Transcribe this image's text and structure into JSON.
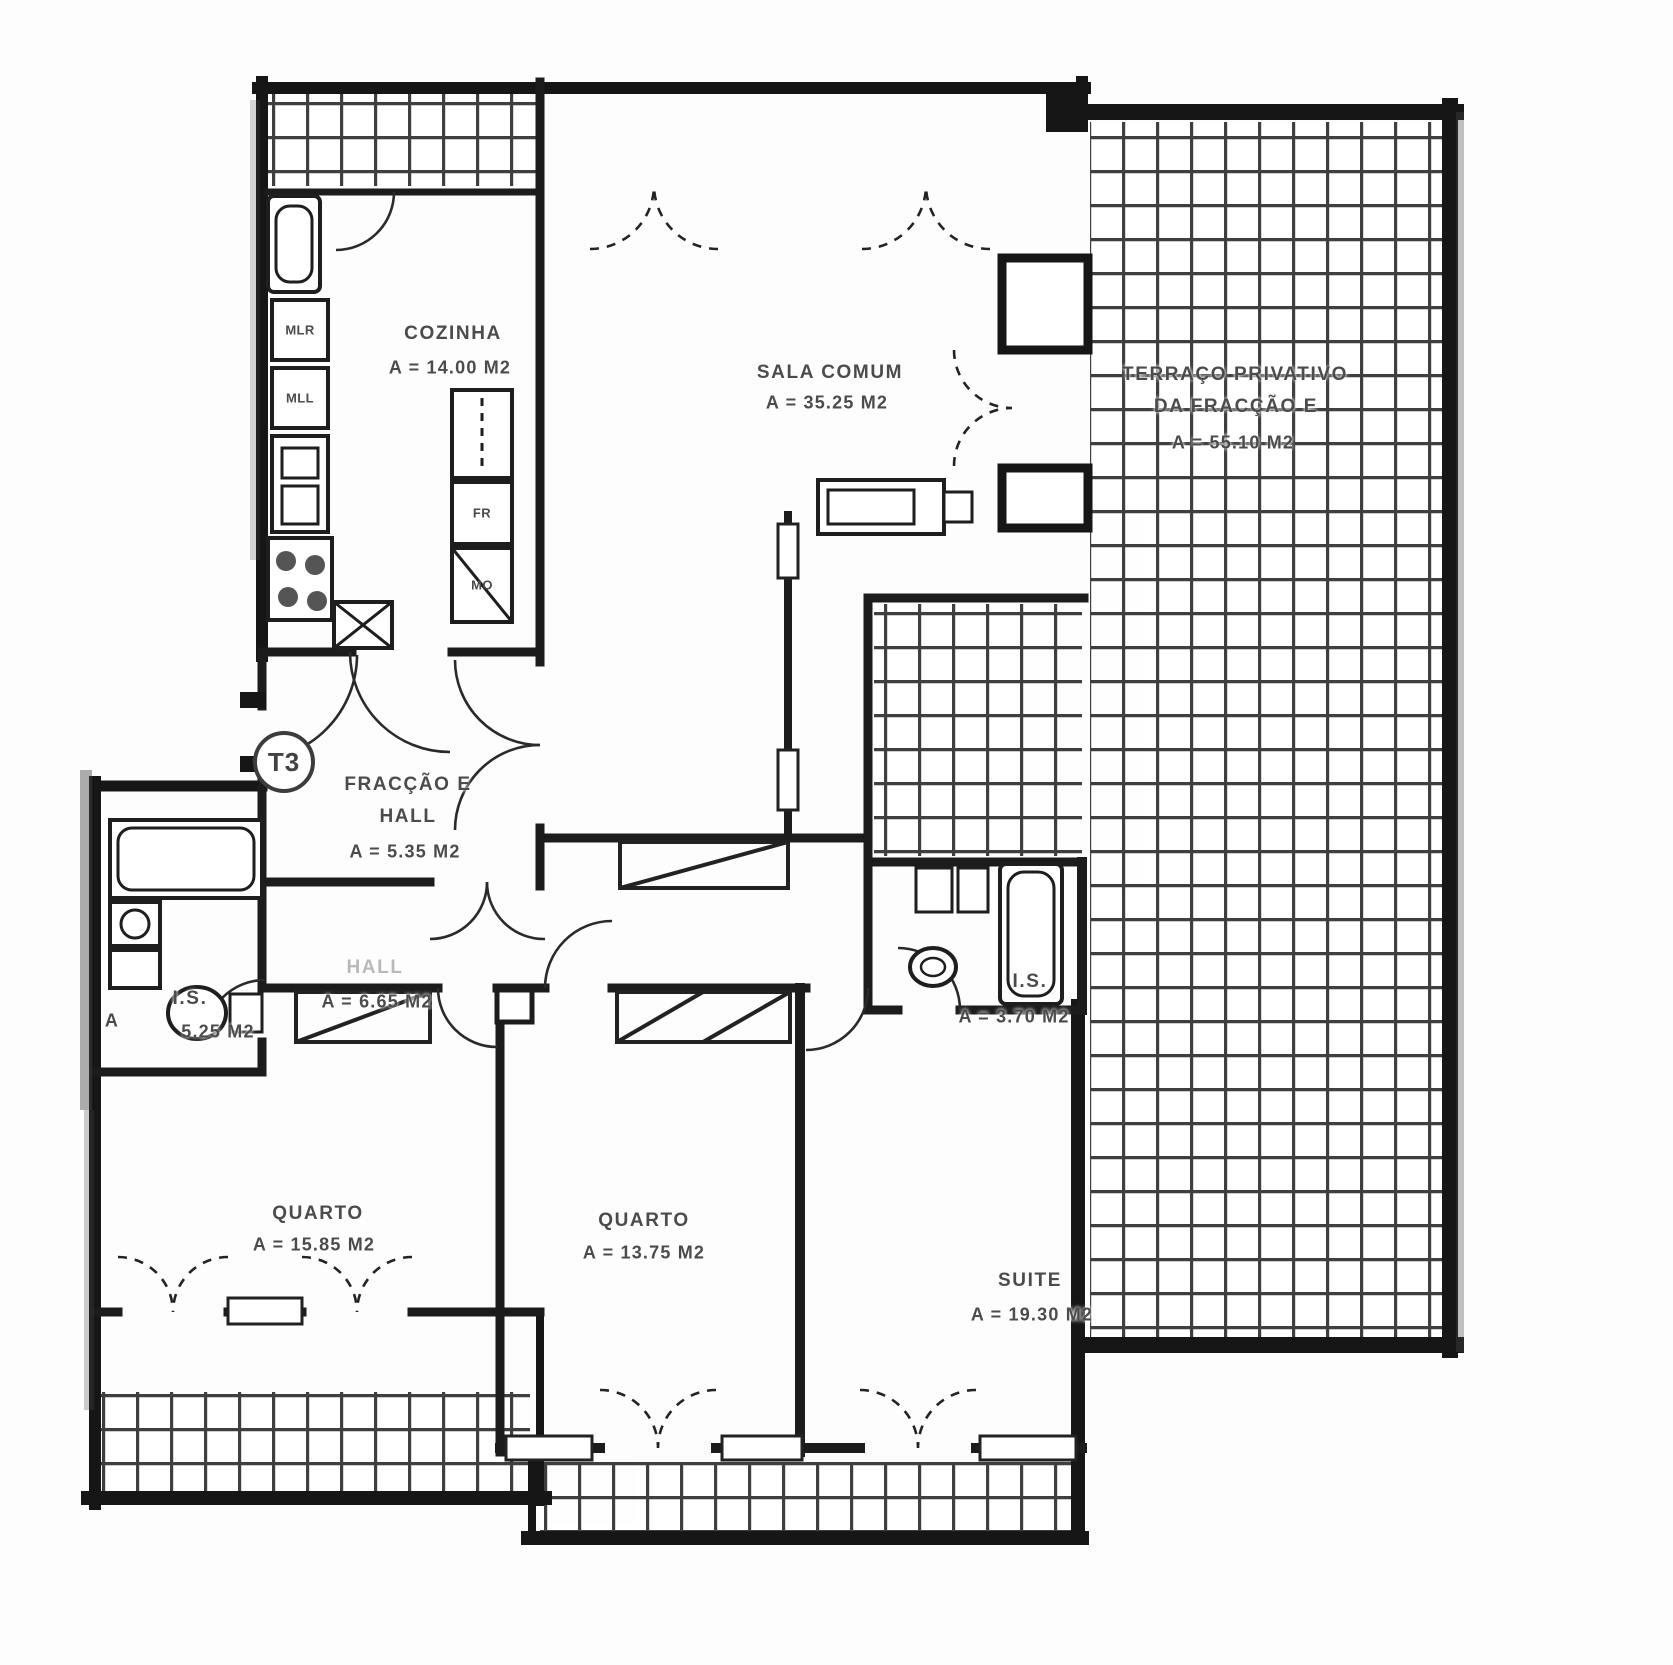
{
  "plan": {
    "unit_badge": "T3",
    "ink_color": "#1a1a1a",
    "paper_color": "#fdfdfd",
    "rooms": [
      {
        "id": "cozinha",
        "label": "COZINHA",
        "area": "A = 14.00 M2"
      },
      {
        "id": "sala-comum",
        "label": "SALA COMUM",
        "area": "A = 35.25 M2"
      },
      {
        "id": "terraco",
        "label": "TERRAÇO PRIVATIVO",
        "label2": "DA FRACÇÃO E",
        "area": "A = 55.10 M2"
      },
      {
        "id": "fraccao-hall",
        "label": "FRACÇÃO E",
        "label2": "HALL",
        "area": "A = 5.35 M2"
      },
      {
        "id": "hall",
        "label": "HALL",
        "area": "A = 6.65 M2"
      },
      {
        "id": "is-1",
        "label": "I.S.",
        "prefix": "A",
        "area": "5.25 M2"
      },
      {
        "id": "is-2",
        "label": "I.S.",
        "area": "A = 3.70 M2"
      },
      {
        "id": "quarto-1",
        "label": "QUARTO",
        "area": "A = 15.85 M2"
      },
      {
        "id": "quarto-2",
        "label": "QUARTO",
        "area": "A = 13.75 M2"
      },
      {
        "id": "suite",
        "label": "SUITE",
        "area": "A = 19.30 M2"
      }
    ],
    "appliances": [
      {
        "id": "mlr",
        "label": "MLR"
      },
      {
        "id": "mll",
        "label": "MLL"
      },
      {
        "id": "fr",
        "label": "FR"
      },
      {
        "id": "mo",
        "label": "MO"
      }
    ]
  }
}
